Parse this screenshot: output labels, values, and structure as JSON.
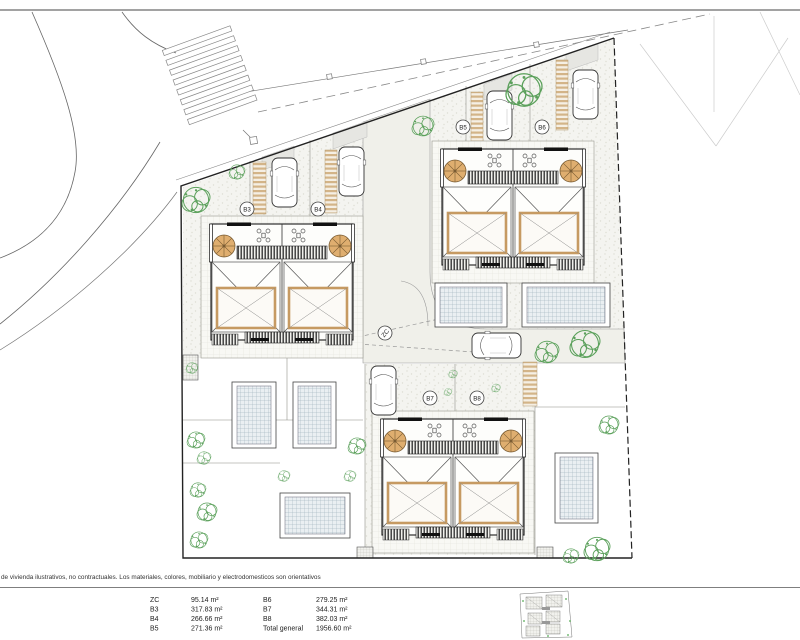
{
  "plan": {
    "labels": {
      "zc": "ZC",
      "b3": "B3",
      "b4": "B4",
      "b5": "B5",
      "b6": "B6",
      "b7": "B7",
      "b8": "B8"
    },
    "colors": {
      "tree_green": "#5aa05a",
      "stair_tan": "#dfae6f",
      "roof_frame_tan": "#c69a62",
      "pool_hatch": "#93a7b4",
      "walkway_tan": "#d3b488"
    }
  },
  "legend": {
    "disclaimer": "de vivienda ilustrativos, no contractuales. Los materiales, colores, mobiliario y electrodomesticos son orientativos",
    "rows_left": [
      {
        "label": "ZC",
        "value": "95.14 m²"
      },
      {
        "label": "B3",
        "value": "317.83 m²"
      },
      {
        "label": "B4",
        "value": "266.66 m²"
      },
      {
        "label": "B5",
        "value": "271.36 m²"
      }
    ],
    "rows_right": [
      {
        "label": "B6",
        "value": "279.25 m²"
      },
      {
        "label": "B7",
        "value": "344.31 m²"
      },
      {
        "label": "B8",
        "value": "382.03 m²"
      },
      {
        "label": "Total general",
        "value": "1956.60 m²"
      }
    ]
  }
}
